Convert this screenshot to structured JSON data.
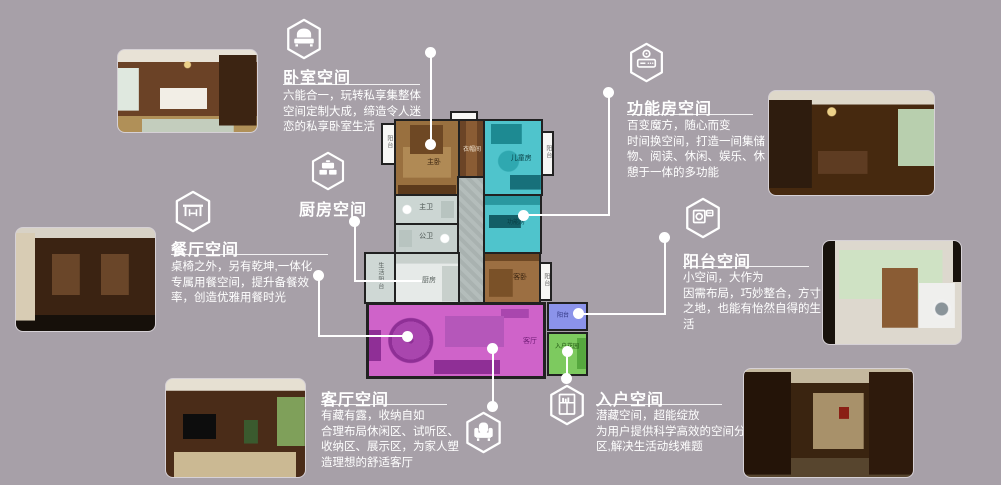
{
  "background_color": "#a7a0a8",
  "accent_line_color": "#ffffff",
  "sections": {
    "bedroom": {
      "title": "卧室空间",
      "desc_lines": [
        "六能合一，玩转私享集整体",
        "空间定制大成，缔造令人迷",
        "恋的私享卧室生活"
      ]
    },
    "kitchen": {
      "title": "厨房空间"
    },
    "dining": {
      "title": "餐厅空间",
      "desc_lines": [
        "桌椅之外，另有乾坤,一体化",
        "专属用餐空间，提升备餐效",
        "率，创造优雅用餐时光"
      ]
    },
    "function_room": {
      "title": "功能房空间",
      "desc_lines": [
        "百变魔方，随心而变",
        "时间换空间，打造一间集储",
        "物、阅读、休闲、娱乐、休",
        "憩于一体的多功能"
      ]
    },
    "balcony": {
      "title": "阳台空间",
      "desc_lines": [
        "小空间，大作为",
        "因需布局，巧妙整合，方寸",
        "之地，也能有怡然自得的生",
        "活"
      ]
    },
    "living": {
      "title": "客厅空间",
      "desc_lines": [
        "有藏有露，收纳自如",
        "合理布局休闲区、试听区、",
        "收纳区、展示区，为家人塑",
        "造理想的舒适客厅"
      ]
    },
    "entry": {
      "title": "入户空间",
      "desc_lines": [
        "潜藏空间，超能绽放",
        "为用户提供科学高效的空间分",
        "区,解决生活动线难题"
      ]
    }
  },
  "floorplan": {
    "labels": {
      "master_bedroom": "主卧",
      "closet": "衣帽间",
      "kids_room": "儿童房",
      "balcony_top_left": "阳台",
      "balcony_top_right": "阳台",
      "master_bath": "主卫",
      "public_bath": "公卫",
      "function_room": "功能房",
      "kitchen": "厨房",
      "service_balcony": "生活阳台",
      "guest_bedroom": "客卧",
      "guest_balcony": "阳台",
      "living_room": "客厅",
      "small_balcony": "阳台",
      "entry_garden": "入户花园"
    },
    "colors": {
      "wall": "#212121",
      "bedroom_brown": "#99703f",
      "cyan_room": "#4fc4cc",
      "bath_gray": "#ccd6d3",
      "kitchen_light": "#e6eae8",
      "living_dining_magenta": "#cf63c9",
      "small_balcony_periwinkle": "#8b93ea",
      "entry_garden_green": "#7dca5f"
    }
  }
}
